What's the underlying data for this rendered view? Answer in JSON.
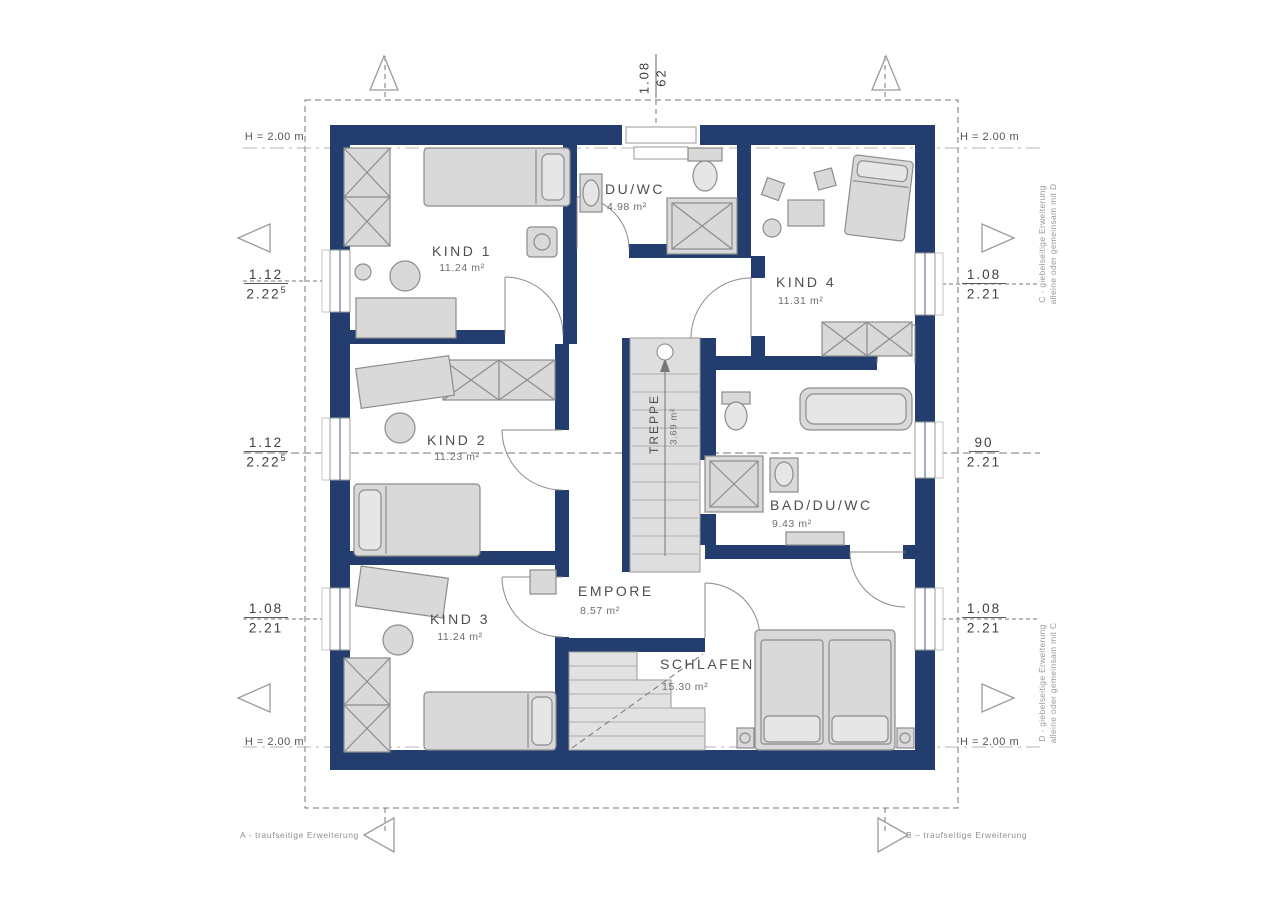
{
  "plan": {
    "rooms": {
      "kind1": {
        "name": "KIND 1",
        "area": "11.24 m²"
      },
      "duwc": {
        "name": "DU/WC",
        "area": "4.98 m²"
      },
      "kind4": {
        "name": "KIND 4",
        "area": "11.31 m²"
      },
      "kind2": {
        "name": "KIND 2",
        "area": "11.23 m²"
      },
      "treppe": {
        "name": "TREPPE",
        "area": "3.69 m²"
      },
      "bad": {
        "name": "BAD/DU/WC",
        "area": "9.43 m²"
      },
      "kind3": {
        "name": "KIND 3",
        "area": "11.24 m²"
      },
      "empore": {
        "name": "EMPORE",
        "area": "8.57 m²"
      },
      "schlafen": {
        "name": "SCHLAFEN",
        "area": "15.30 m²"
      }
    },
    "dimensions": {
      "top": {
        "num": "1.08",
        "den": "62"
      },
      "left": [
        {
          "num": "1.12",
          "den": "2.22",
          "den_sup": "5"
        },
        {
          "num": "1.12",
          "den": "2.22",
          "den_sup": "5"
        },
        {
          "num": "1.08",
          "den": "2.21",
          "den_sup": ""
        }
      ],
      "right": [
        {
          "num": "1.08",
          "den": "2.21",
          "den_sup": ""
        },
        {
          "num": "90",
          "den": "2.21",
          "den_sup": ""
        },
        {
          "num": "1.08",
          "den": "2.21",
          "den_sup": ""
        }
      ]
    },
    "height_label": "H = 2.00 m",
    "notes": {
      "c_line1": "C - giebelseitige Erweiterung",
      "c_line2": "alleine oder gemeinsam mit D",
      "d_line1": "D - giebelseitige Erweiterung",
      "d_line2": "alleine oder gemeinsam mit C",
      "a": "A - traufseitige Erweiterung",
      "b": "B – traufseitige Erweiterung"
    },
    "colors": {
      "wall": "#233d6e",
      "furniture_fill": "#d9d9d9",
      "furniture_stroke": "#8c8c8c",
      "line": "#888888"
    }
  }
}
